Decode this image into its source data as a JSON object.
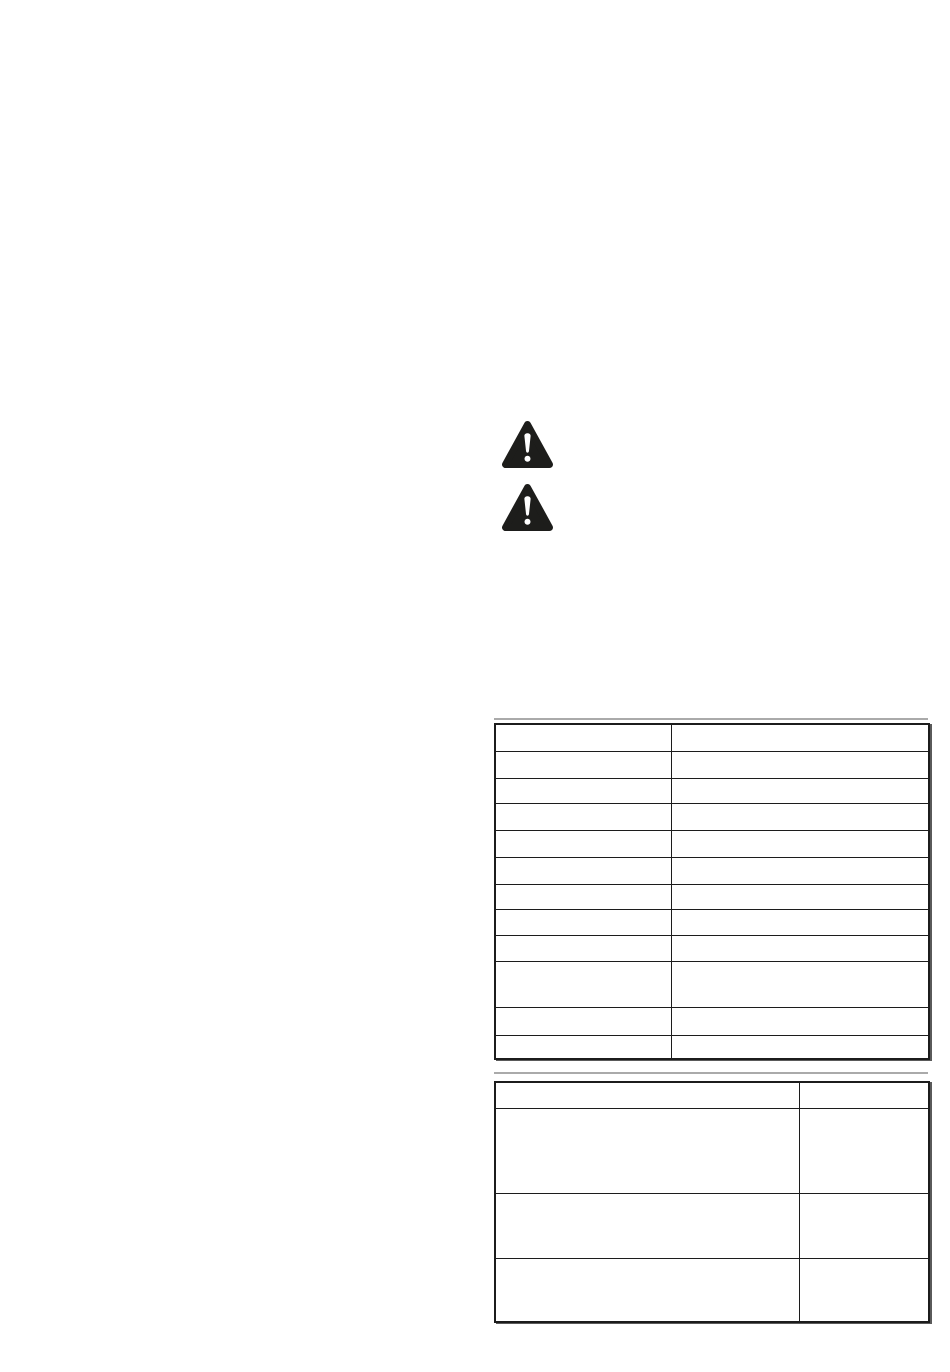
{
  "document": {
    "page_background": "#ffffff",
    "colors": {
      "icon_fill": "#1d1d1b",
      "icon_symbol": "#ffffff",
      "table_border": "#1c1c1c",
      "table_edge_shadow": "#5a5a5a",
      "scan_artifact_line": "#aaaaaa"
    },
    "icons": [
      {
        "name": "warning-triangle-icon",
        "symbol": "exclamation-mark"
      },
      {
        "name": "warning-triangle-icon",
        "symbol": "exclamation-mark"
      }
    ],
    "tables": [
      {
        "columns": 2,
        "rows": [
          [
            "",
            ""
          ],
          [
            "",
            ""
          ],
          [
            "",
            ""
          ],
          [
            "",
            ""
          ],
          [
            "",
            ""
          ],
          [
            "",
            ""
          ],
          [
            "",
            ""
          ],
          [
            "",
            ""
          ],
          [
            "",
            ""
          ],
          [
            "",
            ""
          ],
          [
            "",
            ""
          ],
          [
            "",
            ""
          ]
        ]
      },
      {
        "columns": 2,
        "rows": [
          [
            "",
            ""
          ],
          [
            "",
            ""
          ],
          [
            "",
            ""
          ],
          [
            "",
            ""
          ]
        ]
      }
    ]
  }
}
